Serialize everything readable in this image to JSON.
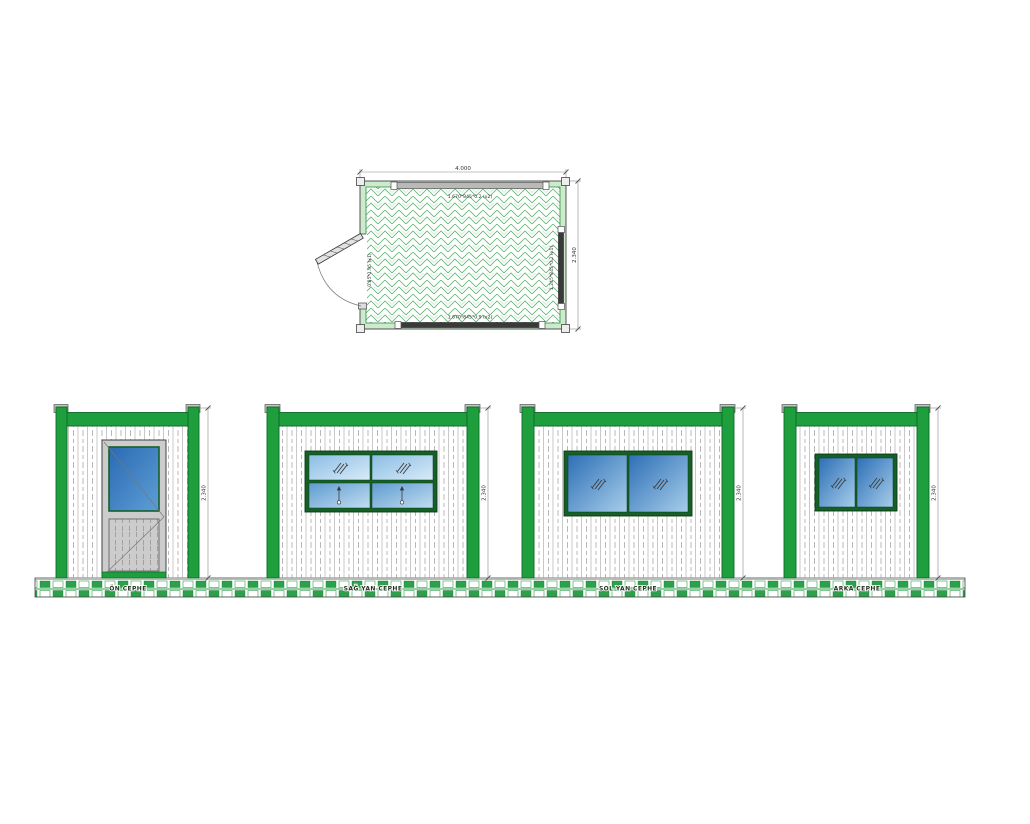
{
  "page": {
    "background": "#ffffff",
    "type": "prefab-container-cad-drawing"
  },
  "colors": {
    "frame_green": "#1f9e3e",
    "frame_green_dark": "#0d6b26",
    "window_frame_green": "#155f28",
    "plan_band_green": "#cdeacc",
    "hatch_green": "#5cb571",
    "glass_dark_blue": "#2d6fb6",
    "glass_light_blue": "#a6cdea",
    "door_gray": "#cccccc",
    "ground_green": "#2ca14b",
    "dimension_gray": "#888888"
  },
  "plan": {
    "dim_width": "4.000",
    "dim_height": "2.340",
    "window_top_label": "1.670*845*0.2 (x2)",
    "window_bottom_label": "1.670*845*0.9 (x2)",
    "window_right_label": "1.245*845*0.2 (x1)",
    "door_label": "0.85*1.95 (x1)"
  },
  "elevations": [
    {
      "id": "front",
      "label": "ÖN CEPHE",
      "height_dim": "2.340",
      "feature": "door"
    },
    {
      "id": "right-side",
      "label": "SAĞ YAN CEPHE",
      "height_dim": "2.340",
      "feature": "window-4-pane"
    },
    {
      "id": "left-side",
      "label": "SOL YAN CEPHE",
      "height_dim": "2.340",
      "feature": "window-2-pane"
    },
    {
      "id": "back",
      "label": "ARKA CEPHE",
      "height_dim": "2.340",
      "feature": "window-2-pane-small"
    }
  ]
}
